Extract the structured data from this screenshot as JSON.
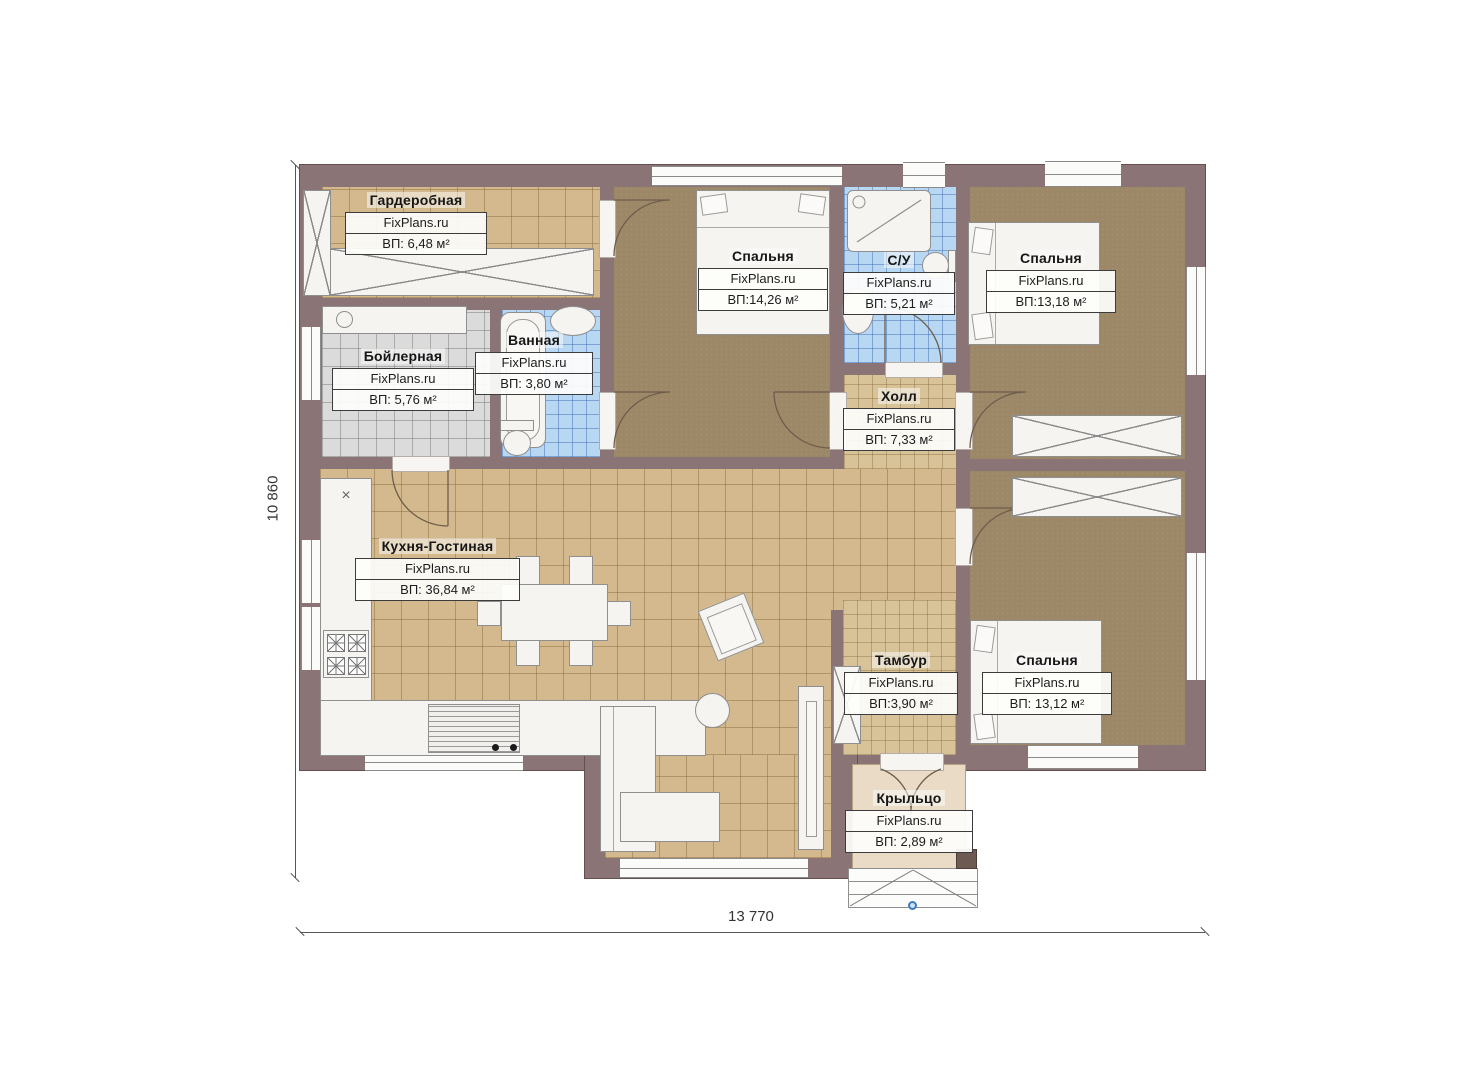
{
  "plan": {
    "brand": "FixPlans.ru",
    "rooms": {
      "garderobnaya": {
        "name": "Гардеробная",
        "brand": "FixPlans.ru",
        "area": "ВП: 6,48 м²"
      },
      "boylernaya": {
        "name": "Бойлерная",
        "brand": "FixPlans.ru",
        "area": "ВП: 5,76 м²"
      },
      "vannaya": {
        "name": "Ванная",
        "brand": "FixPlans.ru",
        "area": "ВП: 3,80 м²"
      },
      "spalnya1": {
        "name": "Спальня",
        "brand": "FixPlans.ru",
        "area": "ВП:14,26 м²"
      },
      "su": {
        "name": "С/У",
        "brand": "FixPlans.ru",
        "area": "ВП: 5,21 м²"
      },
      "spalnya2": {
        "name": "Спальня",
        "brand": "FixPlans.ru",
        "area": "ВП:13,18 м²"
      },
      "holl": {
        "name": "Холл",
        "brand": "FixPlans.ru",
        "area": "ВП: 7,33 м²"
      },
      "kuhnya": {
        "name": "Кухня-Гостиная",
        "brand": "FixPlans.ru",
        "area": "ВП: 36,84 м²"
      },
      "tambur": {
        "name": "Тамбур",
        "brand": "FixPlans.ru",
        "area": "ВП:3,90 м²"
      },
      "spalnya3": {
        "name": "Спальня",
        "brand": "FixPlans.ru",
        "area": "ВП: 13,12 м²"
      },
      "krylco": {
        "name": "Крыльцо",
        "brand": "FixPlans.ru",
        "area": "ВП: 2,89 м²"
      }
    },
    "dimensions": {
      "height": "10 860",
      "width": "13 770"
    },
    "colors": {
      "wall": "#8b7476",
      "bedroom_floor": "#9c8767",
      "tile_tan": "#d3b98d",
      "tile_blue": "#b7d7f3",
      "tile_gray": "#dbdbdb",
      "porch": "#e9dbc5"
    }
  }
}
